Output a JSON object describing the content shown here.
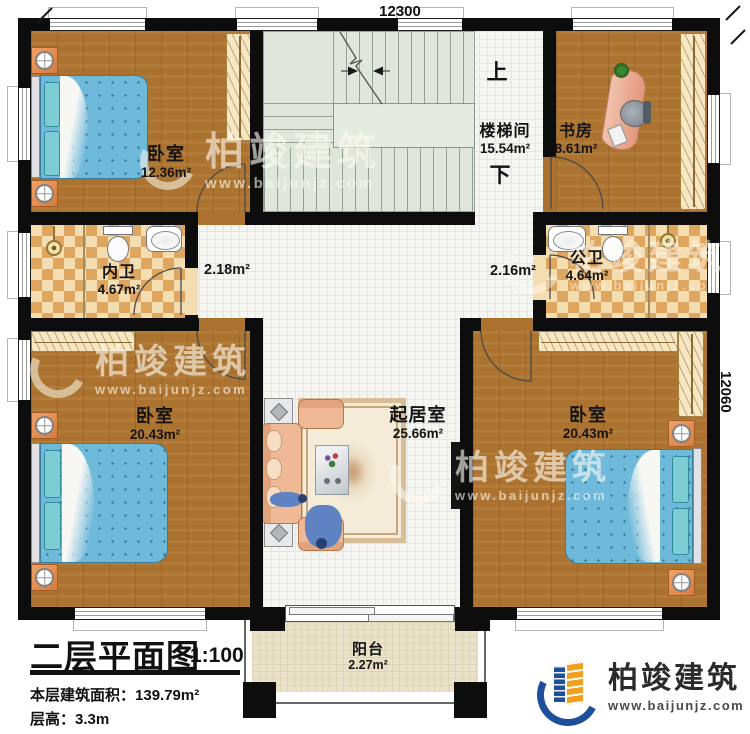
{
  "title": {
    "text": "二层平面图",
    "scale": "1:100"
  },
  "info": {
    "area_label": "本层建筑面积：",
    "area_value": "139.79m²",
    "height_label": "层高：",
    "height_value": "3.3m"
  },
  "dimensions": {
    "top": "12300",
    "right": "12060"
  },
  "stairs": {
    "up": "上",
    "down": "下"
  },
  "rooms": {
    "bedroom_top_left": {
      "name": "卧室",
      "area": "12.36m²"
    },
    "stairwell": {
      "name": "楼梯间",
      "area": "15.54m²"
    },
    "study": {
      "name": "书房",
      "area": "8.61m²"
    },
    "bath_inner": {
      "name": "内卫",
      "area": "4.67m²"
    },
    "bath_public": {
      "name": "公卫",
      "area": "4.64m²"
    },
    "hall_left": {
      "area": "2.18m²"
    },
    "hall_right": {
      "area": "2.16m²"
    },
    "living": {
      "name": "起居室",
      "area": "25.66m²"
    },
    "bedroom_bottom_left": {
      "name": "卧室",
      "area": "20.43m²"
    },
    "bedroom_bottom_right": {
      "name": "卧室",
      "area": "20.43m²"
    },
    "balcony": {
      "name": "阳台",
      "area": "2.27m²"
    }
  },
  "branding": {
    "company": "柏竣建筑",
    "website": "www.baijunjz.com"
  },
  "watermark": {
    "company": "柏竣建筑",
    "website": "www.baijunjz.com"
  },
  "colors": {
    "wall": "#0d0d0d",
    "wood_floor": "#ac7330",
    "tile_floor": "#f5f5f2",
    "stair_floor": "#e0e6db",
    "bathroom_tile": "#dfa660",
    "bed": "#6fb9da",
    "sofa": "#efb997",
    "brand_blue": "#1d4f9b",
    "brand_orange": "#f0a01e"
  }
}
